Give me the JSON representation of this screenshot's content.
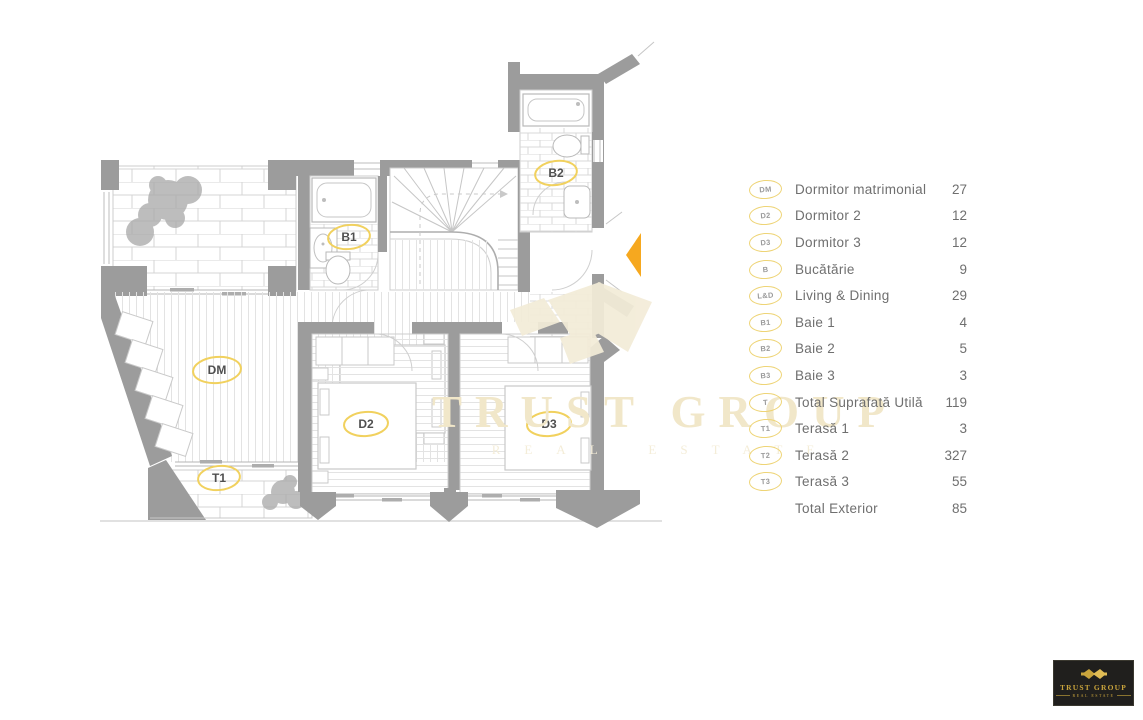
{
  "plan": {
    "labels": {
      "dm": "DM",
      "d2": "D2",
      "d3": "D3",
      "b1": "B1",
      "b2": "B2",
      "t1": "T1"
    }
  },
  "legend": {
    "items": [
      {
        "code": "DM",
        "label": "Dormitor matrimonial",
        "value": "27"
      },
      {
        "code": "D2",
        "label": "Dormitor 2",
        "value": "12"
      },
      {
        "code": "D3",
        "label": "Dormitor 3",
        "value": "12"
      },
      {
        "code": "B",
        "label": "Bucătărie",
        "value": "9"
      },
      {
        "code": "L&D",
        "label": "Living & Dining",
        "value": "29"
      },
      {
        "code": "B1",
        "label": "Baie 1",
        "value": "4"
      },
      {
        "code": "B2",
        "label": "Baie 2",
        "value": "5"
      },
      {
        "code": "B3",
        "label": "Baie 3",
        "value": "3"
      },
      {
        "code": "T",
        "label": "Total Suprafată Utilă",
        "value": "119"
      },
      {
        "code": "T1",
        "label": "Terasă 1",
        "value": "3"
      },
      {
        "code": "T2",
        "label": "Terasă 2",
        "value": "327"
      },
      {
        "code": "T3",
        "label": "Terasă 3",
        "value": "55"
      },
      {
        "code": "",
        "label": "Total Exterior",
        "value": "85"
      }
    ]
  },
  "watermark": {
    "title": "TRUST GROUP",
    "subtitle": "REAL ESTATE"
  },
  "logo": {
    "title": "TRUST GROUP",
    "subtitle": "REAL ESTATE"
  },
  "colors": {
    "wall": "#9c9c9c",
    "accent_yellow": "#eed476",
    "entrance_arrow": "#f6a81f",
    "watermark_beige": "#f3ecd8",
    "logo_background": "#201f1d",
    "logo_gold": "#c9a43c"
  }
}
